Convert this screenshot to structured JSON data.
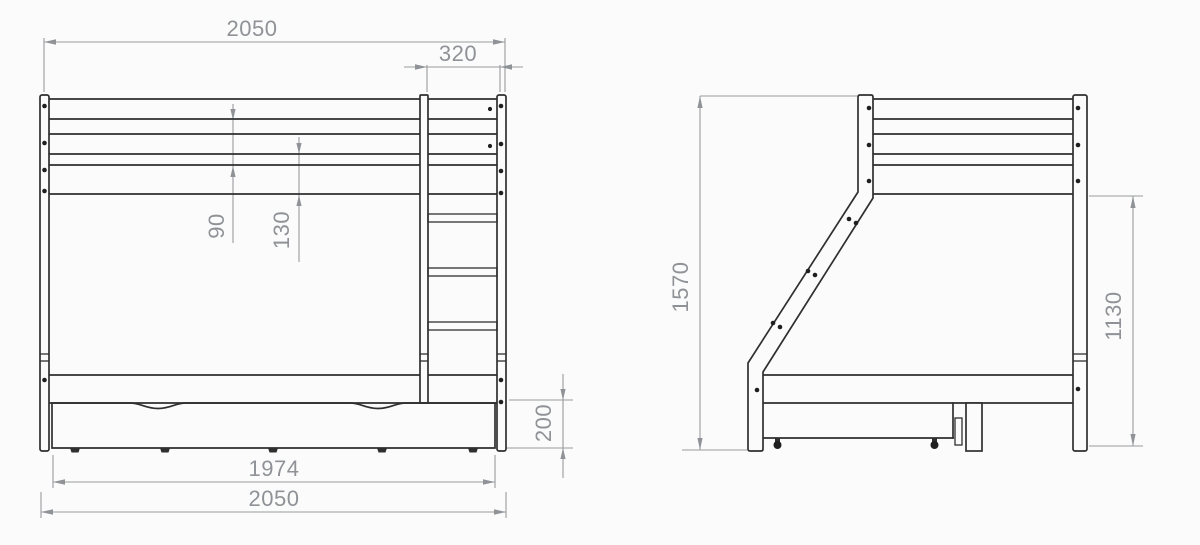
{
  "drawing": {
    "subject": "bunk-bed with ladder and storage drawer, front and side elevations",
    "units": "mm",
    "colors": {
      "outline": "#2f2f2f",
      "dimension_lines": "#9a9c9e",
      "dimension_text": "#8f9296",
      "background": "#fbfbfb"
    },
    "front_view": {
      "dims": {
        "total_width_top": "2050",
        "ladder_width": "320",
        "rail_spacing_upper": "90",
        "rail_spacing_lower": "130",
        "drawer_height": "200",
        "drawer_width": "1974",
        "total_width_bottom": "2050"
      }
    },
    "side_view": {
      "dims": {
        "total_height": "1570",
        "upper_frame_height": "1130"
      }
    }
  }
}
